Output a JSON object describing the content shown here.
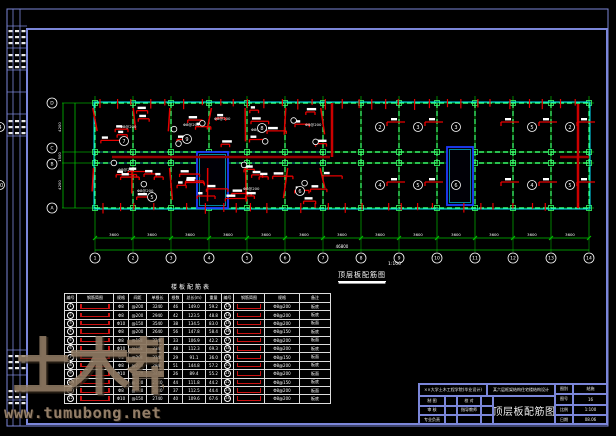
{
  "sheet": {
    "border_color": "#7b86d9",
    "background": "#000000"
  },
  "watermark": {
    "logo_text": "土木帮",
    "url_text": "www.tumubong.net",
    "color": "#9b8774"
  },
  "side_strip": {
    "labels": [
      "会签",
      "专业",
      "姓名",
      "日期"
    ]
  },
  "plan": {
    "caption": "顶层板配筋图",
    "scale": "1:100",
    "axes_bottom": [
      "1",
      "2",
      "3",
      "4",
      "5",
      "6",
      "7",
      "8",
      "9",
      "10",
      "11",
      "12",
      "13",
      "14"
    ],
    "axes_left": [
      "D",
      "C",
      "B",
      "A"
    ],
    "dim_segment_label": "3600",
    "dim_total_label": "46800",
    "dim_left_labels": [
      "4200",
      "1500",
      "4200"
    ],
    "rebar_label": "Φ8@200",
    "slab_numbers_top": [
      "2",
      "3",
      "3",
      "",
      "5",
      "2",
      "4"
    ],
    "slab_numbers_bottom": [
      "4",
      "5",
      "6",
      "",
      "4",
      "5",
      "10"
    ],
    "slab_numbers_left": [
      [
        "7",
        124,
        141
      ],
      [
        "9",
        187,
        139
      ],
      [
        "8",
        262,
        128
      ],
      [
        "6",
        300,
        191
      ],
      [
        "5",
        152,
        197
      ]
    ],
    "colors": {
      "grid": "#00a400",
      "beam": "#39ff6a",
      "outline": "#00e5ff",
      "rebar": "#e60000",
      "rebar_dark": "#990000",
      "shaft": "#1e3cff",
      "wall": "#008080",
      "dim": "#00c000",
      "text": "#ffffff"
    }
  },
  "table": {
    "title": "楼板配筋表",
    "headers": [
      "编号",
      "钢筋简图",
      "规格",
      "间距",
      "单根长",
      "根数",
      "总长(m)",
      "重量",
      "编号",
      "钢筋简图",
      "规格",
      "备注"
    ],
    "rows": [
      [
        "1",
        "BAR",
        "Φ8",
        "@200",
        "3240",
        "46",
        "149.0",
        "59.2",
        "13",
        "BAR",
        "Φ8@200",
        "板底"
      ],
      [
        "2",
        "BAR",
        "Φ8",
        "@200",
        "2940",
        "42",
        "123.5",
        "48.8",
        "14",
        "BAR",
        "Φ8@200",
        "板底"
      ],
      [
        "3",
        "BAR",
        "Φ10",
        "@150",
        "3540",
        "38",
        "134.5",
        "83.0",
        "15",
        "BAR",
        "Φ8@200",
        "板面"
      ],
      [
        "4",
        "BAR",
        "Φ8",
        "@200",
        "2640",
        "56",
        "147.8",
        "58.4",
        "16",
        "BAR",
        "Φ8@150",
        "板底"
      ],
      [
        "5",
        "BAR",
        "Φ8",
        "@180",
        "3240",
        "33",
        "106.9",
        "42.2",
        "17",
        "BAR",
        "Φ8@200",
        "板面"
      ],
      [
        "6",
        "BAR",
        "Φ10",
        "@150",
        "2340",
        "48",
        "112.3",
        "69.3",
        "18",
        "BAR",
        "Φ8@200",
        "板底"
      ],
      [
        "7",
        "BAR",
        "Φ8",
        "@200",
        "3140",
        "29",
        "91.1",
        "36.0",
        "19",
        "BAR",
        "Φ8@150",
        "板面"
      ],
      [
        "8",
        "BAR",
        "Φ8",
        "@200",
        "2840",
        "51",
        "144.8",
        "57.2",
        "20",
        "BAR",
        "Φ8@200",
        "板底"
      ],
      [
        "9",
        "BAR",
        "Φ10",
        "@120",
        "3440",
        "26",
        "89.4",
        "55.2",
        "21",
        "BAR",
        "Φ8@200",
        "板面"
      ],
      [
        "10",
        "BAR",
        "Φ8",
        "@200",
        "2540",
        "44",
        "111.8",
        "44.2",
        "22",
        "BAR",
        "Φ8@150",
        "板底"
      ],
      [
        "11",
        "BAR",
        "Φ8",
        "@180",
        "3040",
        "37",
        "112.5",
        "44.4",
        "23",
        "BAR",
        "Φ8@200",
        "板面"
      ],
      [
        "12",
        "BAR",
        "Φ10",
        "@150",
        "2740",
        "40",
        "109.6",
        "67.6",
        "24",
        "BAR",
        "Φ8@200",
        "板底"
      ]
    ]
  },
  "title_block": {
    "company": "××大学土木工程学院(毕业设计)",
    "project": "某六层框架结构住宅楼结构设计",
    "drawing_title": "顶层板配筋图",
    "left_rows": [
      [
        "制 图",
        "校 对"
      ],
      [
        "审 核",
        "指导教师"
      ],
      [
        "专业负责",
        ""
      ]
    ],
    "right_rows": [
      [
        "图别",
        "结施"
      ],
      [
        "图号",
        "16"
      ],
      [
        "比例",
        "1:100"
      ],
      [
        "日期",
        "08.06"
      ]
    ]
  }
}
